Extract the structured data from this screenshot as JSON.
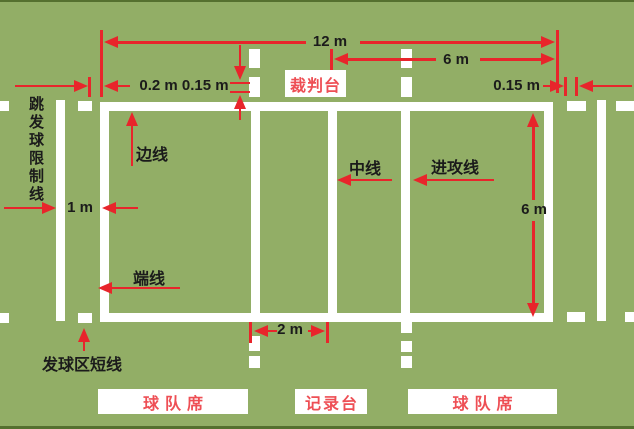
{
  "labels": {
    "jump_serve_restriction_line": "跳发球限制线",
    "side_line": "边线",
    "center_line": "中线",
    "attack_line": "进攻线",
    "end_line": "端线",
    "serve_zone_short_line": "发球区短线",
    "referee_stand": "裁判台",
    "team_bench_left": "球队席",
    "scorer_table": "记录台",
    "team_bench_right": "球队席"
  },
  "dimensions": {
    "court_length": "12 m",
    "half_court_length": "6 m",
    "line_gap": "0.2 m",
    "mark_length": "0.15 m",
    "mark_length_right": "0.15 m",
    "restriction_line_distance": "1 m",
    "attack_line_to_center": "2 m",
    "court_width": "6 m"
  },
  "colors": {
    "background": "#92ae66",
    "border_strip": "#55702f",
    "court_line": "#ffffff",
    "dimension_red": "#e8252b",
    "label_text": "#1b1b1b",
    "box_label_red": "#ee4f55"
  }
}
